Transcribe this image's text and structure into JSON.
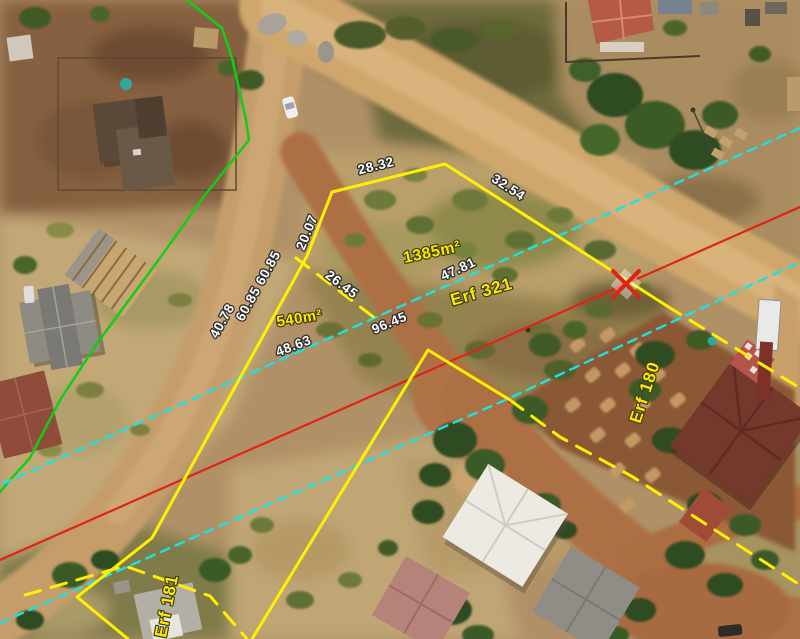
{
  "scene": {
    "title": "Aerial cadastral survey map",
    "width_px": 800,
    "height_px": 639
  },
  "colors": {
    "boundary_yellow": "#ffef00",
    "traverse_cyan": "#1be2e2",
    "red_line": "#e02413",
    "green_line": "#14cd14",
    "label_white": "#ffffff",
    "label_yellow": "#ffe800"
  },
  "overlay": {
    "measurements": [
      {
        "id": "m-2832",
        "text": "28.32"
      },
      {
        "id": "m-3254",
        "text": "32.54"
      },
      {
        "id": "m-2007",
        "text": "20.07"
      },
      {
        "id": "m-2645",
        "text": "26.45"
      },
      {
        "id": "m-4781",
        "text": "47.81"
      },
      {
        "id": "m-6085",
        "text": "60.85 60.85"
      },
      {
        "id": "m-4078",
        "text": "40.78"
      },
      {
        "id": "m-9645",
        "text": "96.45"
      },
      {
        "id": "m-4863",
        "text": "48.63"
      }
    ],
    "areas": [
      {
        "id": "a-1385",
        "text": "1385m²"
      },
      {
        "id": "a-540",
        "text": "540m²"
      }
    ],
    "parcels": [
      {
        "id": "p-321",
        "text": "Erf 321"
      },
      {
        "id": "p-180",
        "text": "Erf 180"
      },
      {
        "id": "p-181",
        "text": "Erf 181"
      }
    ],
    "beacon": {
      "shape": "x-cross",
      "color": "#e02413"
    }
  }
}
